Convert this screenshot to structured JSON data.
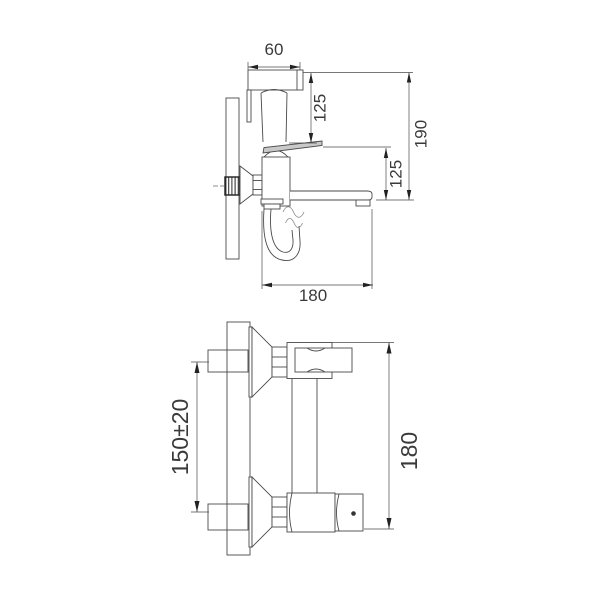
{
  "document": {
    "kind": "faucet installation dimension drawing",
    "background": "#ffffff"
  },
  "side_view": {
    "dims": {
      "sprayer_head_width": "60",
      "head_to_lever_height": "125",
      "overall_height": "190",
      "lever_to_spout_height": "125",
      "spout_depth": "180"
    }
  },
  "front_view": {
    "dims": {
      "supply_center_distance": "150±20",
      "overall_width": "180"
    }
  },
  "colors": {
    "line": "#4a4a4a",
    "hatch": "#b5b5b5",
    "arrow": "#222222",
    "text": "#3a3a3a"
  }
}
